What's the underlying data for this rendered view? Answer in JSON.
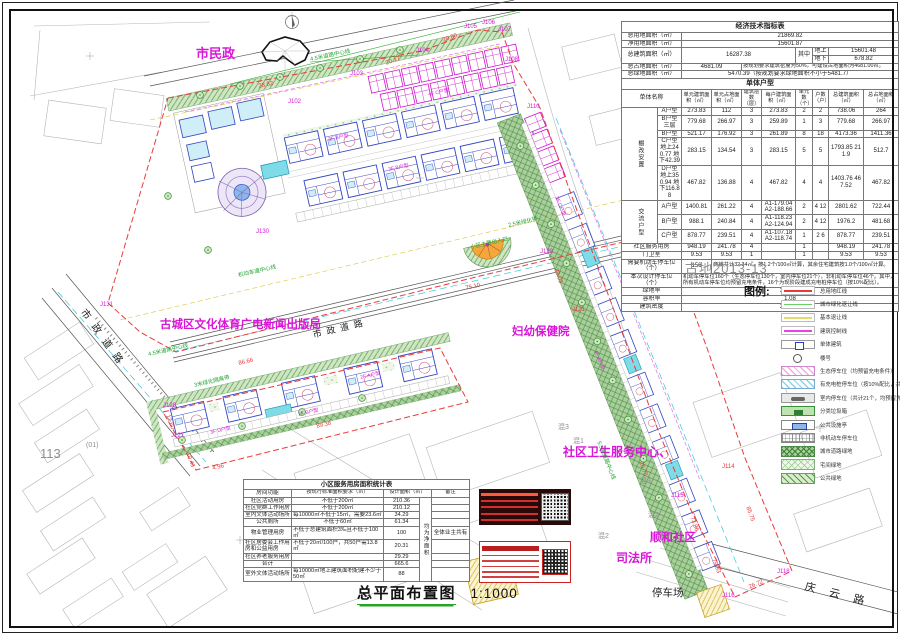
{
  "sheet": {
    "number": "古地2013-13"
  },
  "title_block": {
    "title": "总平面布置图",
    "scale": "1:1000"
  },
  "econ_table": {
    "cols": [
      36,
      24,
      30,
      30,
      20,
      34,
      17,
      16,
      35,
      35
    ],
    "rows": [
      [
        {
          "t": "经济技术指标表",
          "cs": 10,
          "c": "th"
        }
      ],
      [
        {
          "t": "总用地面积（㎡）",
          "cs": 2,
          "c": "lbl"
        },
        {
          "t": "21869.82",
          "cs": 8
        }
      ],
      [
        {
          "t": "净用地面积（㎡）",
          "cs": 2,
          "c": "lbl"
        },
        {
          "t": "15601.87",
          "cs": 8
        }
      ],
      [
        {
          "t": "总建筑面积（㎡）",
          "cs": 2,
          "rs": 2,
          "c": "lbl"
        },
        {
          "t": "16287.38",
          "cs": 4,
          "rs": 2
        },
        {
          "t": "其中",
          "rs": 2
        },
        {
          "t": "地上"
        },
        {
          "t": "15601.48",
          "cs": 2
        }
      ],
      [
        {
          "t": "地下"
        },
        {
          "t": "678.82",
          "cs": 2
        }
      ],
      [
        {
          "t": "总占地面积（㎡）",
          "cs": 2,
          "c": "lbl"
        },
        {
          "t": "4681.09",
          "cs": 2
        },
        {
          "t": "按规划要求建筑密度为50%，可建设占地面积为4681.00㎡。",
          "cs": 6,
          "c": "sm"
        }
      ],
      [
        {
          "t": "总绿地面积（㎡）",
          "cs": 2,
          "c": "lbl"
        },
        {
          "t": "5470.39（按规划要求绿地面积不小于5481.7）",
          "cs": 8
        }
      ],
      [
        {
          "t": "单体户型",
          "cs": 10,
          "c": "th"
        }
      ],
      [
        {
          "t": "单体名称",
          "cs": 2
        },
        {
          "t": "单元建筑面积（㎡）",
          "c": "smc"
        },
        {
          "t": "单元占地面积（㎡）",
          "c": "smc"
        },
        {
          "t": "建筑层数（层）",
          "c": "smc"
        },
        {
          "t": "每户建筑面积（㎡）",
          "c": "smc"
        },
        {
          "t": "单元数（个）",
          "c": "smc"
        },
        {
          "t": "户数（户）",
          "c": "smc"
        },
        {
          "t": "总建筑面积（㎡）",
          "c": "smc"
        },
        {
          "t": "总占地面积（㎡）",
          "c": "smc"
        }
      ],
      [
        {
          "t": "棚改安置",
          "rs": 5,
          "c": "vert"
        },
        {
          "t": "A户型"
        },
        {
          "t": "273.83"
        },
        {
          "t": "112"
        },
        {
          "t": "3"
        },
        {
          "t": "273.83"
        },
        {
          "t": "2"
        },
        {
          "t": "2"
        },
        {
          "t": "738.06"
        },
        {
          "t": "264"
        }
      ],
      [
        {
          "t": "B户型三层"
        },
        {
          "t": "779.68"
        },
        {
          "t": "266.97"
        },
        {
          "t": "3"
        },
        {
          "t": "259.89"
        },
        {
          "t": "1"
        },
        {
          "t": "3"
        },
        {
          "t": "779.68"
        },
        {
          "t": "266.97"
        }
      ],
      [
        {
          "t": "B户型"
        },
        {
          "t": "521.17"
        },
        {
          "t": "176.92"
        },
        {
          "t": "3"
        },
        {
          "t": "261.89"
        },
        {
          "t": "8"
        },
        {
          "t": "18"
        },
        {
          "t": "4173.36"
        },
        {
          "t": "1411.36"
        }
      ],
      [
        {
          "t": "C户型 地上240.77 地下42.39"
        },
        {
          "t": "283.15"
        },
        {
          "t": "134.54"
        },
        {
          "t": "3"
        },
        {
          "t": "283.15"
        },
        {
          "t": "5"
        },
        {
          "t": "5"
        },
        {
          "t": "1793.85 211.9"
        },
        {
          "t": "512.7"
        }
      ],
      [
        {
          "t": "D户型 地上350.94 地下116.88"
        },
        {
          "t": "467.82"
        },
        {
          "t": "136.88"
        },
        {
          "t": "4"
        },
        {
          "t": "467.82"
        },
        {
          "t": "4"
        },
        {
          "t": "4"
        },
        {
          "t": "1403.76 467.52"
        },
        {
          "t": "467.82"
        }
      ],
      [
        {
          "t": "交流户型",
          "rs": 3,
          "c": "vert"
        },
        {
          "t": "A户型"
        },
        {
          "t": "1400.81"
        },
        {
          "t": "261.22"
        },
        {
          "t": "4"
        },
        {
          "t": "A1-179.04 A2-188.66"
        },
        {
          "t": "2"
        },
        {
          "t": "4 12"
        },
        {
          "t": "2801.62"
        },
        {
          "t": "722.44"
        }
      ],
      [
        {
          "t": "B户型"
        },
        {
          "t": "988.1"
        },
        {
          "t": "240.84"
        },
        {
          "t": "4"
        },
        {
          "t": "A1-118.23 A2-124.94"
        },
        {
          "t": "2"
        },
        {
          "t": "4 12"
        },
        {
          "t": "1976.2"
        },
        {
          "t": "481.68"
        }
      ],
      [
        {
          "t": "C户型"
        },
        {
          "t": "878.77"
        },
        {
          "t": "239.51"
        },
        {
          "t": "4"
        },
        {
          "t": "A1-107.18 A2-118.74"
        },
        {
          "t": "1"
        },
        {
          "t": "2 6"
        },
        {
          "t": "878.77"
        },
        {
          "t": "239.51"
        }
      ],
      [
        {
          "t": "社区服务用房",
          "cs": 2
        },
        {
          "t": "948.19"
        },
        {
          "t": "241.78"
        },
        {
          "t": "4"
        },
        {
          "t": ""
        },
        {
          "t": "1"
        },
        {
          "t": ""
        },
        {
          "t": "948.19"
        },
        {
          "t": "241.78"
        }
      ],
      [
        {
          "t": "门卫室",
          "cs": 2
        },
        {
          "t": "9.53"
        },
        {
          "t": "9.53"
        },
        {
          "t": "1"
        },
        {
          "t": ""
        },
        {
          "t": "1"
        },
        {
          "t": ""
        },
        {
          "t": "9.53"
        },
        {
          "t": "9.53"
        }
      ],
      [
        {
          "t": "需要机动车停车位（个）",
          "cs": 2,
          "c": "lbl"
        },
        {
          "t": "156"
        },
        {
          "t": "商铺共计32.34㎡，按1.2个/100㎡计算，其余住宅建筑按1.0个/100㎡计算。",
          "cs": 7,
          "c": "sm"
        }
      ],
      [
        {
          "t": "本次设计停车位（个）",
          "cs": 2,
          "c": "lbl"
        },
        {
          "t": "机动车停车位160个（生态停车位130个，室内停车位21个），非机动车停车位46个。其中，所有机动车停车位均预留充电条件，16个为现阶段建成充电桩停车位（按10%配比）。",
          "cs": 8,
          "c": "sm"
        }
      ],
      [
        {
          "t": "绿地率",
          "cs": 2,
          "c": "lbl"
        },
        {
          "t": "35.00%",
          "cs": 8
        }
      ],
      [
        {
          "t": "容积率",
          "cs": 2,
          "c": "lbl"
        },
        {
          "t": "1.08",
          "cs": 8
        }
      ],
      [
        {
          "t": "建筑密度",
          "cs": 2,
          "c": "lbl"
        },
        {
          "t": "26.38%",
          "cs": 8
        }
      ]
    ]
  },
  "service_table": {
    "cols": [
      48,
      92,
      36,
      12,
      38
    ],
    "rows": [
      [
        {
          "t": "小区服务用房面积统计表",
          "cs": 5,
          "c": "th"
        }
      ],
      [
        {
          "t": "房间功能"
        },
        {
          "t": "按现行标准面积要求（㎡）",
          "c": "smc"
        },
        {
          "t": "设计面积（㎡）",
          "cs": 2,
          "c": "smc"
        },
        {
          "t": "备注",
          "c": "smc"
        }
      ],
      [
        {
          "t": "社区活动用房"
        },
        {
          "t": "不低于200㎡"
        },
        {
          "t": "210.36"
        },
        {
          "t": "均为净面积",
          "rs": 9,
          "c": "vert"
        },
        {
          "t": ""
        }
      ],
      [
        {
          "t": "社区党群工作用房"
        },
        {
          "t": "不低于200㎡"
        },
        {
          "t": "210.12"
        },
        {
          "t": ""
        }
      ],
      [
        {
          "t": "室内文体活动场所"
        },
        {
          "t": "每10000㎡不低于15㎡，需要23.6㎡",
          "c": "sm"
        },
        {
          "t": "34.29"
        },
        {
          "t": ""
        }
      ],
      [
        {
          "t": "公共厕所"
        },
        {
          "t": "不低于60㎡"
        },
        {
          "t": "61.34"
        },
        {
          "t": ""
        }
      ],
      [
        {
          "t": "物业管理用房"
        },
        {
          "t": "不低于总建筑面积3‰且不低于100㎡",
          "c": "sm"
        },
        {
          "t": "100"
        },
        {
          "t": "全体业主共有"
        }
      ],
      [
        {
          "t": "社区居委会工作用房和公益用房",
          "c": "sm"
        },
        {
          "t": "不低于20㎡/100户，共50户需13.8㎡",
          "c": "sm"
        },
        {
          "t": "20.31"
        },
        {
          "t": ""
        }
      ],
      [
        {
          "t": "社区养老服务用房"
        },
        {
          "t": ""
        },
        {
          "t": "29.29"
        },
        {
          "t": ""
        }
      ],
      [
        {
          "t": "合计"
        },
        {
          "t": ""
        },
        {
          "t": "665.6"
        },
        {
          "t": ""
        }
      ],
      [
        {
          "t": "室外文体活动场所"
        },
        {
          "t": "每10000㎡地上建筑面积配建不少于50㎡",
          "c": "sm"
        },
        {
          "t": "88"
        },
        {
          "t": ""
        }
      ]
    ]
  },
  "legend": {
    "title": "图例:",
    "items": [
      {
        "sw": "line-red",
        "label": "总用地红线"
      },
      {
        "sw": "line-green",
        "label": "城市绿化退让线"
      },
      {
        "sw": "line-yellow",
        "label": "基本退让线"
      },
      {
        "sw": "line-magenta",
        "label": "建筑控制线"
      },
      {
        "sw": "box-building",
        "label": "单体建筑"
      },
      {
        "sw": "circle",
        "label": "楼号"
      },
      {
        "sw": "hatch-pink",
        "label": "生态停车位（均预留充电条件）"
      },
      {
        "sw": "hatch-blue",
        "label": "有充电桩停车位（按10%配比，共计16个）"
      },
      {
        "sw": "box-car",
        "label": "室内停车位（共计21个，均预留充电设备）"
      },
      {
        "sw": "box-trash",
        "label": "分类垃圾箱"
      },
      {
        "sw": "box-facility",
        "label": "公共设施亭"
      },
      {
        "sw": "grid-gray",
        "label": "非机动车停车位"
      },
      {
        "sw": "hatch-darkgreen",
        "label": "城市道路绿地"
      },
      {
        "sw": "hatch-dotgreen",
        "label": "宅间绿地"
      },
      {
        "sw": "hatch-lightgreen",
        "label": "公共绿地"
      }
    ]
  },
  "plan": {
    "labels": [
      {
        "t": "市民政",
        "x": 196,
        "y": 47,
        "s": 13,
        "c": "m",
        "b": 1
      },
      {
        "t": "古城区文化体育广电新闻出版局",
        "x": 160,
        "y": 320,
        "s": 11.5,
        "c": "m",
        "b": 1
      },
      {
        "t": "妇幼保健院",
        "x": 512,
        "y": 327,
        "s": 11.5,
        "c": "m",
        "b": 1
      },
      {
        "t": "社区卫生服务中心、",
        "x": 563,
        "y": 446,
        "s": 12,
        "c": "m",
        "b": 1
      },
      {
        "t": "顺和社区",
        "x": 650,
        "y": 533,
        "s": 11.5,
        "c": "m",
        "b": 1
      },
      {
        "t": "司法所",
        "x": 616,
        "y": 552,
        "s": 12,
        "c": "m",
        "b": 1
      },
      {
        "t": "停车场",
        "x": 652,
        "y": 588,
        "s": 10.5,
        "c": "k"
      },
      {
        "t": "庆云路",
        "x": 806,
        "y": 582,
        "s": 11,
        "c": "k",
        "rot": 14,
        "ls": 14
      },
      {
        "t": "市政道路",
        "x": 86,
        "y": 308,
        "s": 10,
        "c": "k",
        "rot": 54,
        "ls": 8
      },
      {
        "t": "市政道路",
        "x": 312,
        "y": 331,
        "s": 9,
        "c": "k",
        "rot": -13.5,
        "ls": 5
      },
      {
        "t": "113",
        "x": 40,
        "y": 447,
        "s": 13,
        "c": "gy"
      },
      {
        "t": "(01)",
        "x": 86,
        "y": 442,
        "s": 7,
        "c": "gy"
      },
      {
        "t": "混3",
        "x": 558,
        "y": 424,
        "s": 7,
        "c": "gy"
      },
      {
        "t": "混1",
        "x": 573,
        "y": 438,
        "s": 7,
        "c": "gy"
      },
      {
        "t": "混3",
        "x": 640,
        "y": 478,
        "s": 7,
        "c": "gy"
      },
      {
        "t": "混2",
        "x": 648,
        "y": 512,
        "s": 7,
        "c": "gy"
      },
      {
        "t": "混2",
        "x": 598,
        "y": 533,
        "s": 7,
        "c": "gy"
      },
      {
        "t": "混2",
        "x": 528,
        "y": 500,
        "s": 7,
        "c": "gy"
      },
      {
        "t": "J102",
        "x": 288,
        "y": 99,
        "s": 6,
        "c": "m"
      },
      {
        "t": "J103",
        "x": 350,
        "y": 71,
        "s": 6,
        "c": "m"
      },
      {
        "t": "J104",
        "x": 416,
        "y": 48,
        "s": 6,
        "c": "m"
      },
      {
        "t": "J105",
        "x": 464,
        "y": 24,
        "s": 6,
        "c": "m"
      },
      {
        "t": "J106",
        "x": 482,
        "y": 20,
        "s": 6,
        "c": "m"
      },
      {
        "t": "J107",
        "x": 498,
        "y": 27,
        "s": 6,
        "c": "m"
      },
      {
        "t": "J108",
        "x": 505,
        "y": 57,
        "s": 6,
        "c": "m"
      },
      {
        "t": "J110",
        "x": 527,
        "y": 104,
        "s": 6,
        "c": "m"
      },
      {
        "t": "J131",
        "x": 100,
        "y": 302,
        "s": 6,
        "c": "m"
      },
      {
        "t": "J130",
        "x": 256,
        "y": 229,
        "s": 6,
        "c": "m"
      },
      {
        "t": "J128",
        "x": 163,
        "y": 403,
        "s": 6,
        "c": "m"
      },
      {
        "t": "J127",
        "x": 171,
        "y": 433,
        "s": 6,
        "c": "m"
      },
      {
        "t": "J122",
        "x": 540,
        "y": 249,
        "s": 6,
        "c": "m"
      },
      {
        "t": "J121",
        "x": 572,
        "y": 307,
        "s": 6,
        "c": "r"
      },
      {
        "t": "J114",
        "x": 722,
        "y": 464,
        "s": 6,
        "c": "r"
      },
      {
        "t": "J115",
        "x": 671,
        "y": 493,
        "s": 6,
        "c": "m"
      },
      {
        "t": "J116",
        "x": 722,
        "y": 593,
        "s": 6,
        "c": "m"
      },
      {
        "t": "J118",
        "x": 777,
        "y": 569,
        "s": 6,
        "c": "m"
      },
      {
        "t": "28.82",
        "x": 258,
        "y": 84,
        "s": 6,
        "c": "r",
        "rot": -12
      },
      {
        "t": "20.17",
        "x": 385,
        "y": 61,
        "s": 6,
        "c": "r",
        "rot": -20
      },
      {
        "t": "20.80",
        "x": 442,
        "y": 38,
        "s": 6,
        "c": "r",
        "rot": -20
      },
      {
        "t": "86.66",
        "x": 238,
        "y": 361,
        "s": 6,
        "c": "r",
        "rot": -13
      },
      {
        "t": "75.10",
        "x": 465,
        "y": 286,
        "s": 6,
        "c": "r",
        "rot": -13
      },
      {
        "t": "89.38",
        "x": 316,
        "y": 424,
        "s": 6,
        "c": "r",
        "rot": -13
      },
      {
        "t": "12.60",
        "x": 170,
        "y": 414,
        "s": 6,
        "c": "r",
        "rot": 70
      },
      {
        "t": "10.43",
        "x": 190,
        "y": 452,
        "s": 6,
        "c": "r",
        "rot": 70
      },
      {
        "t": "4.96",
        "x": 212,
        "y": 466,
        "s": 6,
        "c": "r",
        "rot": -13
      },
      {
        "t": "25.75",
        "x": 643,
        "y": 461,
        "s": 6,
        "c": "r",
        "rot": 70
      },
      {
        "t": "73.96",
        "x": 694,
        "y": 516,
        "s": 6,
        "c": "r",
        "rot": 70
      },
      {
        "t": "79.93",
        "x": 716,
        "y": 558,
        "s": 6,
        "c": "r",
        "rot": 70
      },
      {
        "t": "26.72",
        "x": 748,
        "y": 585,
        "s": 6,
        "c": "r",
        "rot": -23
      },
      {
        "t": "85.75",
        "x": 750,
        "y": 506,
        "s": 6,
        "c": "r",
        "rot": 70
      },
      {
        "t": "39.03",
        "x": 558,
        "y": 268,
        "s": 6,
        "c": "r",
        "rot": 70
      },
      {
        "t": "4.5米道路中心线",
        "x": 310,
        "y": 58,
        "s": 5.5,
        "c": "g",
        "rot": -12
      },
      {
        "t": "2.5米绿化带",
        "x": 508,
        "y": 224,
        "s": 5.5,
        "c": "g",
        "rot": -13
      },
      {
        "t": "小区主要出入口",
        "x": 470,
        "y": 246,
        "s": 5.5,
        "c": "g",
        "rot": -13
      },
      {
        "t": "5.5米道路中心线",
        "x": 600,
        "y": 441,
        "s": 5.5,
        "c": "g",
        "rot": 68
      },
      {
        "t": "3米绿化隔离带",
        "x": 194,
        "y": 384,
        "s": 5.5,
        "c": "g",
        "rot": -13
      },
      {
        "t": "机动车道中心线",
        "x": 238,
        "y": 274,
        "s": 5.5,
        "c": "g",
        "rot": -13
      },
      {
        "t": "4.5米道路中心线",
        "x": 148,
        "y": 353,
        "s": 5.5,
        "c": "g",
        "rot": -13
      },
      {
        "t": "4F C户型",
        "x": 428,
        "y": 93,
        "s": 5,
        "c": "m",
        "rot": -12
      },
      {
        "t": "3F B户型",
        "x": 328,
        "y": 138,
        "s": 5,
        "c": "m",
        "rot": -12
      },
      {
        "t": "3F B户型",
        "x": 388,
        "y": 168,
        "s": 5,
        "c": "m",
        "rot": -12
      },
      {
        "t": "2F A户型",
        "x": 360,
        "y": 376,
        "s": 5,
        "c": "m",
        "rot": -13
      },
      {
        "t": "2F B户型",
        "x": 298,
        "y": 413,
        "s": 5,
        "c": "m",
        "rot": -13
      },
      {
        "t": "3F D户型",
        "x": 210,
        "y": 431,
        "s": 5,
        "c": "m",
        "rot": -13
      },
      {
        "t": "4F A户型",
        "x": 597,
        "y": 350,
        "s": 5,
        "c": "m",
        "rot": 68
      },
      {
        "t": "3F C户型",
        "x": 558,
        "y": 196,
        "s": 5,
        "c": "m",
        "rot": 68
      }
    ]
  },
  "stamps": {
    "left_stamp": "approval-seal-dark",
    "right_stamp": "approval-seal-red"
  },
  "colors": {
    "boundary_red": "#e83b3b",
    "magenta": "#d816d8",
    "green_note": "#1fa32f",
    "building_blue": "#3244c0",
    "green_fill": "#a9cf9b",
    "cyan_water": "#35c8dc"
  }
}
